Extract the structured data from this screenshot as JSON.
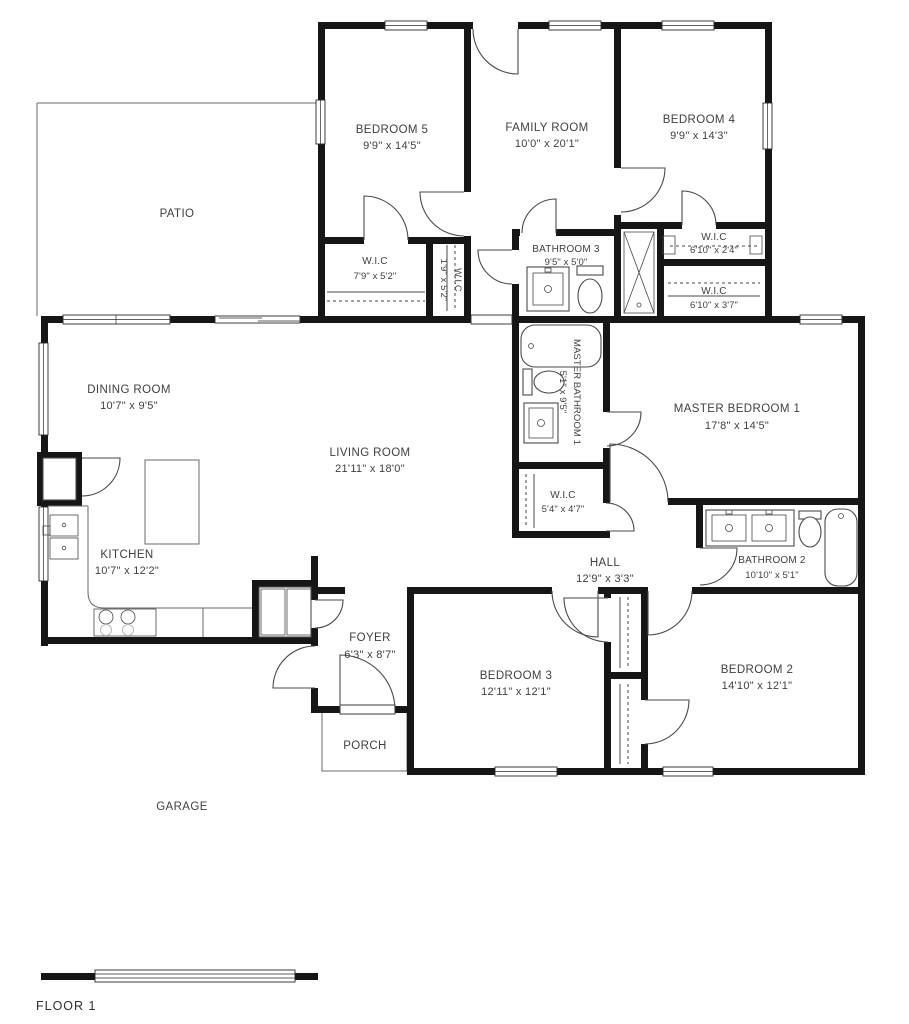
{
  "floor_label": "FLOOR 1",
  "colors": {
    "wall": "#161616",
    "background": "#ffffff",
    "label_text": "#3f3f3f",
    "fixture_line": "#4a4a4a"
  },
  "rooms": {
    "bedroom5": {
      "name": "BEDROOM 5",
      "dims": "9'9\" x 14'5\""
    },
    "family_room": {
      "name": "FAMILY ROOM",
      "dims": "10'0\" x 20'1\""
    },
    "bedroom4": {
      "name": "BEDROOM 4",
      "dims": "9'9\" x 14'3\""
    },
    "patio": {
      "name": "PATIO"
    },
    "wic_bed5": {
      "name": "W.I.C",
      "dims": "7'9\" x 5'2\""
    },
    "wic_narrow": {
      "name": "W.I.C",
      "dims": "1'9\" x 5'2\""
    },
    "bathroom3": {
      "name": "BATHROOM 3",
      "dims": "9'5\" x 5'0\""
    },
    "wic_24": {
      "name": "W.I.C",
      "dims": "6'10\" x 2'4\""
    },
    "wic_37": {
      "name": "W.I.C",
      "dims": "6'10\" x 3'7\""
    },
    "dining_room": {
      "name": "DINING ROOM",
      "dims": "10'7\" x 9'5\""
    },
    "master_bath": {
      "name": "MASTER BATHROOM 1",
      "dims": "5'1\" x 9'5\""
    },
    "master_bed": {
      "name": "MASTER BEDROOM 1",
      "dims": "17'8\" x 14'5\""
    },
    "living_room": {
      "name": "LIVING ROOM",
      "dims": "21'11\" x 18'0\""
    },
    "wic_master": {
      "name": "W.I.C",
      "dims": "5'4\" x 4'7\""
    },
    "kitchen": {
      "name": "KITCHEN",
      "dims": "10'7\" x 12'2\""
    },
    "hall": {
      "name": "HALL",
      "dims": "12'9\" x 3'3\""
    },
    "bathroom2": {
      "name": "BATHROOM 2",
      "dims": "10'10\" x 5'1\""
    },
    "foyer": {
      "name": "FOYER",
      "dims": "6'3\" x 8'7\""
    },
    "bedroom3": {
      "name": "BEDROOM 3",
      "dims": "12'11\" x 12'1\""
    },
    "bedroom2": {
      "name": "BEDROOM 2",
      "dims": "14'10\" x 12'1\""
    },
    "porch": {
      "name": "PORCH"
    },
    "garage": {
      "name": "GARAGE"
    }
  }
}
